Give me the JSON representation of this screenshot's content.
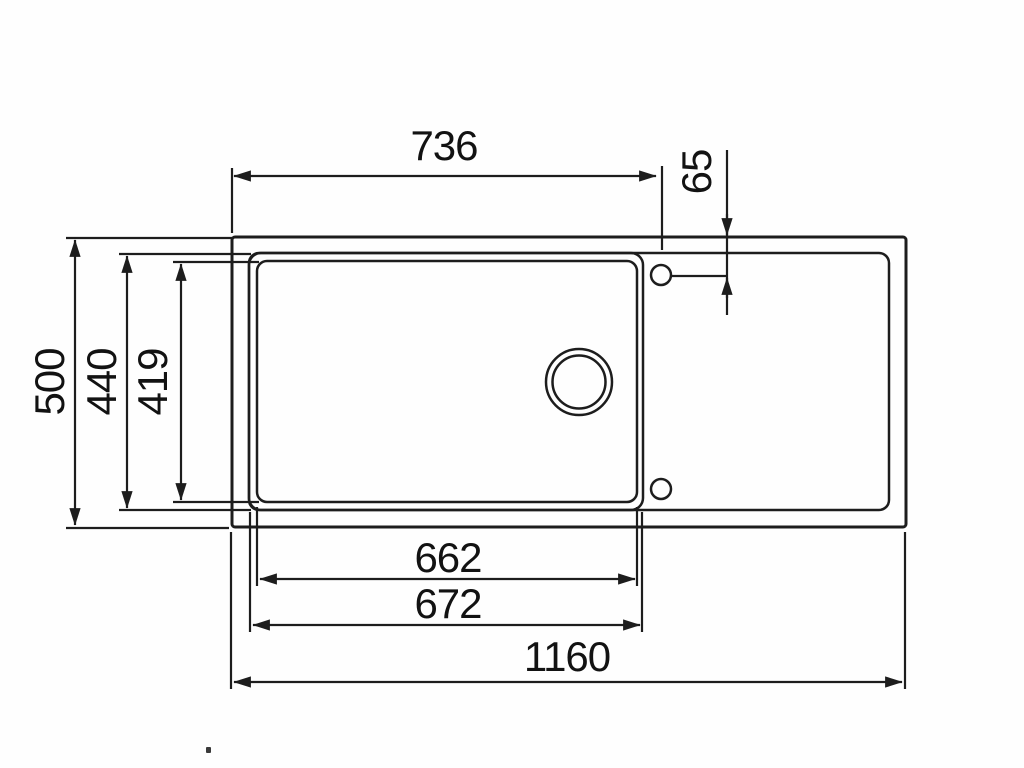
{
  "colors": {
    "line": "#1d1d1d",
    "text": "#121212",
    "background": "#fefefe"
  },
  "dimensions": {
    "left_edge_to_hole_center": {
      "value": "736"
    },
    "hole_center_offset": {
      "value": "65"
    },
    "overall_depth": {
      "value": "500"
    },
    "bowl_outer_depth": {
      "value": "440"
    },
    "bowl_inner_depth": {
      "value": "419"
    },
    "bowl_inner_width": {
      "value": "662"
    },
    "bowl_outer_width": {
      "value": "672"
    },
    "overall_width": {
      "value": "1160"
    }
  }
}
